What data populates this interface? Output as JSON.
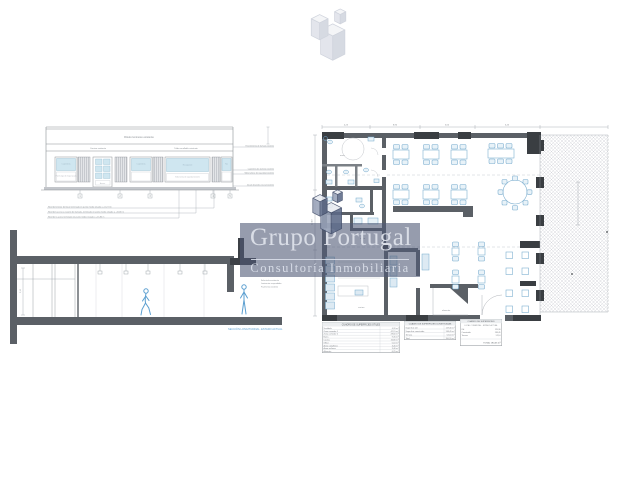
{
  "colors": {
    "brand_slate": "#505a76",
    "drawing_blue": "#74a9cc",
    "wall_gray": "#5b6066",
    "figure_blue": "#5b9fd0"
  },
  "watermark": {
    "brand": "Grupo Portugal",
    "tagline": "Consultoría Inmobiliaria"
  },
  "elevation": {
    "sign_label": "Rótulo luminoso existente",
    "band_label_left": "Cornisa existente",
    "band_label_right": "Toldo enrollable existente",
    "window_label": "Carpintería",
    "door_label": "Acceso",
    "wide_window_label": "Escaparate",
    "narrow_window_label": "Fijo",
    "panel_note": "Panel ciego de chapa lacada",
    "note_1": "Nivel del interior del local terminado en punto medio situado a +15,74 m",
    "note_2": "Nivel del acceso a rasante de fachada, terminado en punto medio situado a +15,80 m",
    "note_3": "Nivel de la acera terminado en punto medio situado a +15,85 m",
    "side_note_1": "Revestimiento de fachada existente",
    "side_note_2": "Carpintería de aluminio existente",
    "side_note_3": "Vidrio laminar de seguridad existente",
    "side_note_4": "Zócalo de piedra natural existente",
    "markers": [
      "1",
      "2",
      "3",
      "4",
      "5"
    ]
  },
  "section": {
    "caption": "SECCIÓN LONGITUDINAL. ESTADO ACTUAL",
    "dim_label": "3,10",
    "note_1": "Falso techo existente",
    "note_2": "Luminarias suspendidas",
    "note_3": "Pavimento existente"
  },
  "plan": {
    "dim_top_1": "4,25",
    "dim_top_2": "8,90",
    "dim_top_3": "5,60",
    "dim_top_4": "3,45",
    "dim_side": "12,40",
    "room_aseo": "aseo",
    "room_office": "office",
    "room_cocina": "cocina",
    "room_almacen": "almacén"
  },
  "legend": {
    "t1": {
      "title": "CUADRO DE SUPERFICIES ÚTILES",
      "rows": [
        {
          "label": "Vestíbulo",
          "value": "4,20 m²"
        },
        {
          "label": "Zona comedor 1",
          "value": "42,15 m²"
        },
        {
          "label": "Zona comedor 2",
          "value": "28,60 m²"
        },
        {
          "label": "Barra",
          "value": "9,35 m²"
        },
        {
          "label": "Cocina",
          "value": "16,80 m²"
        },
        {
          "label": "Office",
          "value": "5,10 m²"
        },
        {
          "label": "Aseo caballeros",
          "value": "3,45 m²"
        },
        {
          "label": "Aseo señoras",
          "value": "3,40 m²"
        },
        {
          "label": "Almacén",
          "value": "6,25 m²"
        }
      ]
    },
    "t2": {
      "title": "CUADRO DE SUPERFICIES CONSTRUIDAS",
      "rows": [
        {
          "label": "Superficie útil",
          "value": "119,30 m²"
        },
        {
          "label": "Superficie construida",
          "value": "138,45 m²"
        },
        {
          "label": "Terraza",
          "value": "52,10 m²"
        },
        {
          "label": "Total",
          "value": "190,55 m²"
        }
      ]
    },
    "t3": {
      "title": "CUADRO DE SUPERFICIES",
      "subtitle": "LOCAL COMERCIAL · ESTADO ACTUAL",
      "rows": [
        {
          "label": "Útil",
          "value": "119,30"
        },
        {
          "label": "Construida",
          "value": "138,45"
        },
        {
          "label": "Terraza",
          "value": "52,10"
        }
      ],
      "total": "TOTAL 190,55 m²"
    }
  }
}
